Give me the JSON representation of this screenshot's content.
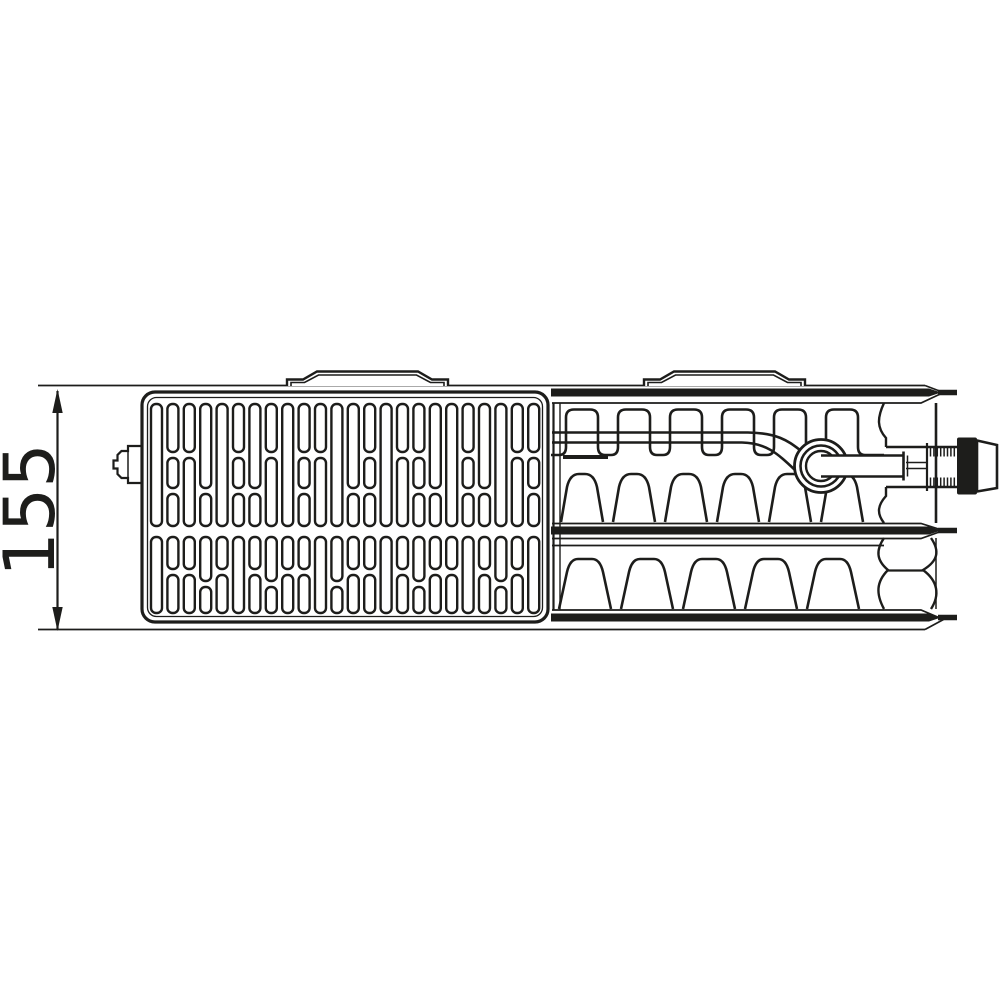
{
  "colors": {
    "line": "#1d1d1b",
    "background": "#ffffff"
  },
  "dimension": {
    "label": "155"
  },
  "tabs": {
    "positions": [
      287,
      644
    ],
    "width": 162
  },
  "grille": {
    "x0": 151,
    "pitch": 16.4,
    "slotW": 11,
    "rows": [
      {
        "y": 404,
        "pattern": "BADCBACDBADBCABDACBACBDA",
        "types": {
          "A": [
            [
              0,
              48
            ],
            [
              54,
              84
            ],
            [
              90,
              122
            ]
          ],
          "B": [
            [
              0,
              122
            ]
          ],
          "C": [
            [
              0,
              84
            ],
            [
              90,
              122
            ]
          ],
          "D": [
            [
              0,
              48
            ],
            [
              54,
              122
            ]
          ]
        }
      },
      {
        "y": 537,
        "pattern": "FEEGEFEGEEFGEEFEGEEFEGEF",
        "types": {
          "E": [
            [
              0,
              32
            ],
            [
              38,
              76
            ]
          ],
          "F": [
            [
              0,
              76
            ]
          ],
          "G": [
            [
              0,
              44
            ],
            [
              50,
              76
            ]
          ]
        }
      }
    ]
  },
  "convector": {
    "topUpper": {
      "xStart": 551,
      "x0": 566,
      "pitch": 52,
      "archW": 32,
      "count": 6,
      "yTop": 409.5,
      "yBot": 455,
      "xEnd": 884
    },
    "topLower": {
      "x0": 582,
      "pitch": 52,
      "count": 6,
      "yTop": 474,
      "yBot": 522,
      "halfBase": 21,
      "halfTop": 13,
      "flat": 3
    },
    "bottom": {
      "x0": 585,
      "pitch": 62,
      "count": 5,
      "yTop": 559,
      "yBot": 609,
      "halfBase": 26,
      "halfTop": 16,
      "flat": 7
    }
  }
}
